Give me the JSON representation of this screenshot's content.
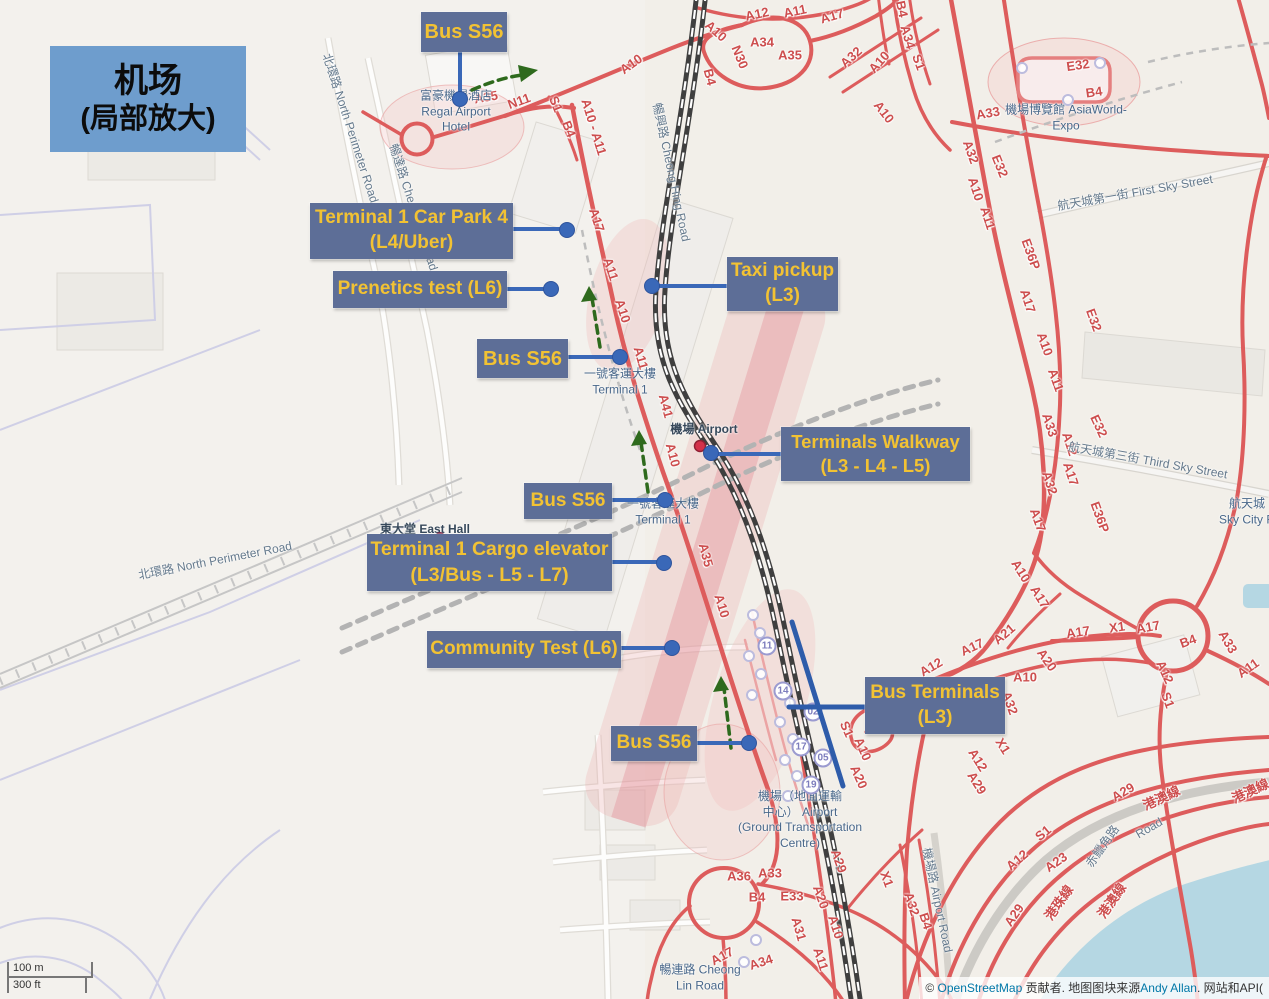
{
  "title": {
    "line1": "机场",
    "line2": "(局部放大)"
  },
  "annotations": {
    "bus_s56_top": {
      "text": "Bus S56"
    },
    "car_park": {
      "line1": "Terminal 1 Car Park 4",
      "line2": "(L4/Uber)"
    },
    "prenetics": {
      "text": "Prenetics test (L6)"
    },
    "taxi": {
      "line1": "Taxi pickup",
      "line2": "(L3)"
    },
    "bus_s56_2": {
      "text": "Bus S56"
    },
    "walkway": {
      "line1": "Terminals Walkway",
      "line2": "(L3 - L4 - L5)"
    },
    "bus_s56_3": {
      "text": "Bus S56"
    },
    "cargo": {
      "line1": "Terminal 1 Cargo elevator",
      "line2": "(L3/Bus - L5 - L7)"
    },
    "community": {
      "text": "Community Test (L6)"
    },
    "bus_terminals": {
      "line1": "Bus Terminals",
      "line2": "(L3)"
    },
    "bus_s56_4": {
      "text": "Bus S56"
    }
  },
  "map": {
    "places": [
      {
        "x": 456,
        "y": 112,
        "lines": [
          "富豪機場酒店",
          "Regal Airport",
          "Hotel"
        ]
      },
      {
        "x": 1066,
        "y": 118,
        "lines": [
          "機場博覽館 AsiaWorld-",
          "Expo"
        ]
      },
      {
        "x": 620,
        "y": 382,
        "lines": [
          "一號客運大樓",
          "Terminal 1"
        ]
      },
      {
        "x": 663,
        "y": 512,
        "lines": [
          "一號客運大樓",
          "Terminal 1"
        ]
      },
      {
        "x": 704,
        "y": 430,
        "dark": true,
        "lines": [
          "機場 Airport"
        ]
      },
      {
        "x": 425,
        "y": 530,
        "dark": true,
        "lines": [
          "東大堂 East Hall"
        ]
      },
      {
        "x": 800,
        "y": 820,
        "lines": [
          "機場（地面運輸",
          "中心） Airport",
          "(Ground Transportation",
          "Centre)"
        ]
      },
      {
        "x": 700,
        "y": 978,
        "lines": [
          "暢連路 Cheong",
          "Lin Road"
        ]
      },
      {
        "x": 1247,
        "y": 512,
        "lines": [
          "航天城",
          "Sky City R"
        ]
      }
    ],
    "street_names": [
      [
        "北環路 North Perimeter Road",
        351,
        128,
        72
      ],
      [
        "暢達路 Cheong Tat Road",
        414,
        207,
        72
      ],
      [
        "北環路 North Perimeter Road",
        215,
        560,
        -11
      ],
      [
        "暢興路 Cheong Hing Road",
        672,
        172,
        78
      ],
      [
        "機場路 Airport Road",
        938,
        900,
        78
      ],
      [
        "航天城第一街 First Sky Street",
        1135,
        192,
        -10
      ],
      [
        "航天城第三街 Third Sky Street",
        1148,
        460,
        10
      ],
      [
        "赤鱲角路",
        1102,
        846,
        -55
      ],
      [
        "Road",
        1149,
        828,
        -30
      ]
    ],
    "road_refs": [
      [
        "A12",
        757,
        14,
        -12
      ],
      [
        "A11",
        795,
        11,
        -12
      ],
      [
        "A17",
        832,
        16,
        -16
      ],
      [
        "A10",
        716,
        31,
        42
      ],
      [
        "B4",
        710,
        77,
        75
      ],
      [
        "N30",
        740,
        57,
        68
      ],
      [
        "A34",
        762,
        42,
        0
      ],
      [
        "A35",
        790,
        55,
        0
      ],
      [
        "A32",
        851,
        57,
        -42
      ],
      [
        "A10",
        879,
        62,
        -48
      ],
      [
        "B4",
        902,
        9,
        78
      ],
      [
        "A34",
        908,
        37,
        74
      ],
      [
        "S1",
        919,
        62,
        70
      ],
      [
        "A10",
        884,
        112,
        52
      ],
      [
        "A33",
        988,
        113,
        -10
      ],
      [
        "E32",
        1078,
        65,
        -8
      ],
      [
        "B4",
        1094,
        92,
        -8
      ],
      [
        "A35",
        486,
        97,
        -10
      ],
      [
        "N11",
        519,
        101,
        -20
      ],
      [
        "S1",
        556,
        104,
        68
      ],
      [
        "B4",
        569,
        129,
        68
      ],
      [
        "A10 - A11",
        594,
        127,
        73
      ],
      [
        "A10",
        631,
        64,
        -36
      ],
      [
        "A17",
        597,
        220,
        72
      ],
      [
        "A11",
        611,
        269,
        72
      ],
      [
        "A10",
        623,
        311,
        72
      ],
      [
        "A11",
        641,
        358,
        74
      ],
      [
        "A41",
        666,
        406,
        75
      ],
      [
        "A10",
        673,
        455,
        75
      ],
      [
        "A35",
        706,
        555,
        75
      ],
      [
        "A10",
        722,
        606,
        73
      ],
      [
        "S1",
        847,
        729,
        66
      ],
      [
        "A10",
        863,
        749,
        66
      ],
      [
        "A20",
        859,
        777,
        66
      ],
      [
        "A36",
        739,
        876,
        0
      ],
      [
        "A33",
        770,
        873,
        0
      ],
      [
        "B4",
        757,
        897,
        0
      ],
      [
        "E33",
        792,
        896,
        0
      ],
      [
        "A20",
        821,
        897,
        70
      ],
      [
        "A29",
        839,
        861,
        70
      ],
      [
        "X1",
        887,
        879,
        70
      ],
      [
        "A17",
        722,
        956,
        -28
      ],
      [
        "A34",
        761,
        962,
        -18
      ],
      [
        "A31",
        799,
        929,
        74
      ],
      [
        "A10",
        836,
        927,
        72
      ],
      [
        "A11",
        821,
        959,
        72
      ],
      [
        "A32",
        912,
        904,
        72
      ],
      [
        "B4",
        926,
        921,
        72
      ],
      [
        "A32",
        971,
        152,
        70
      ],
      [
        "E32",
        1000,
        166,
        68
      ],
      [
        "A10",
        976,
        189,
        72
      ],
      [
        "A11",
        988,
        218,
        72
      ],
      [
        "E36P",
        1031,
        254,
        70
      ],
      [
        "A17",
        1028,
        301,
        72
      ],
      [
        "A10",
        1045,
        344,
        70
      ],
      [
        "A11",
        1056,
        380,
        70
      ],
      [
        "E32",
        1094,
        320,
        70
      ],
      [
        "A33",
        1050,
        425,
        72
      ],
      [
        "A12",
        1070,
        444,
        72
      ],
      [
        "A17",
        1071,
        474,
        72
      ],
      [
        "A32",
        1050,
        483,
        72
      ],
      [
        "E32",
        1099,
        426,
        65
      ],
      [
        "E36P",
        1100,
        517,
        70
      ],
      [
        "A17",
        1038,
        520,
        70
      ],
      [
        "A10",
        1021,
        571,
        58
      ],
      [
        "A17",
        1040,
        597,
        58
      ],
      [
        "A21",
        1004,
        634,
        -40
      ],
      [
        "A17",
        972,
        647,
        -25
      ],
      [
        "A12",
        931,
        667,
        -30
      ],
      [
        "A32",
        1010,
        703,
        70
      ],
      [
        "X1",
        1003,
        746,
        58
      ],
      [
        "A12",
        978,
        760,
        58
      ],
      [
        "A29",
        977,
        783,
        58
      ],
      [
        "A10",
        1025,
        677,
        0
      ],
      [
        "A20",
        1047,
        660,
        55
      ],
      [
        "A17",
        1078,
        632,
        -8
      ],
      [
        "X1",
        1117,
        627,
        -8
      ],
      [
        "A17",
        1148,
        627,
        -10
      ],
      [
        "B4",
        1188,
        641,
        -20
      ],
      [
        "A33",
        1228,
        642,
        60
      ],
      [
        "A11",
        1248,
        668,
        -35
      ],
      [
        "A12",
        1165,
        672,
        65
      ],
      [
        "S1",
        1168,
        700,
        70
      ],
      [
        "A29",
        1123,
        792,
        -30
      ],
      [
        "S1",
        1043,
        833,
        -40
      ],
      [
        "A12",
        1017,
        860,
        -40
      ],
      [
        "A23",
        1056,
        862,
        -35
      ],
      [
        "A29",
        1014,
        915,
        -55
      ],
      [
        "港珠線",
        1058,
        902,
        -55
      ],
      [
        "港澳線",
        1111,
        900,
        -55
      ],
      [
        "港澳線",
        1161,
        797,
        -25
      ],
      [
        "港澳線",
        1250,
        790,
        -25
      ]
    ],
    "bus_stops": [
      [
        "11",
        767,
        646
      ],
      [
        "14",
        783,
        691
      ],
      [
        "02",
        813,
        712
      ],
      [
        "17",
        801,
        747
      ],
      [
        "05",
        823,
        758
      ],
      [
        "19",
        811,
        785
      ]
    ],
    "plain_stops": [
      [
        753,
        615
      ],
      [
        760,
        633
      ],
      [
        749,
        656
      ],
      [
        761,
        674
      ],
      [
        752,
        695
      ],
      [
        790,
        703
      ],
      [
        780,
        722
      ],
      [
        793,
        739
      ],
      [
        785,
        760
      ],
      [
        797,
        776
      ],
      [
        788,
        796
      ],
      [
        1022,
        68
      ],
      [
        1100,
        63
      ],
      [
        1068,
        100
      ],
      [
        744,
        962
      ],
      [
        756,
        940
      ]
    ]
  },
  "scale": {
    "metric": "100 m",
    "imperial": "300 ft"
  },
  "attribution": {
    "prefix": "© ",
    "link1": "OpenStreetMap",
    "mid1": " 贡献者. 地图图块来源",
    "link2": "Andy Allan",
    "suffix": ". 网站和API("
  }
}
